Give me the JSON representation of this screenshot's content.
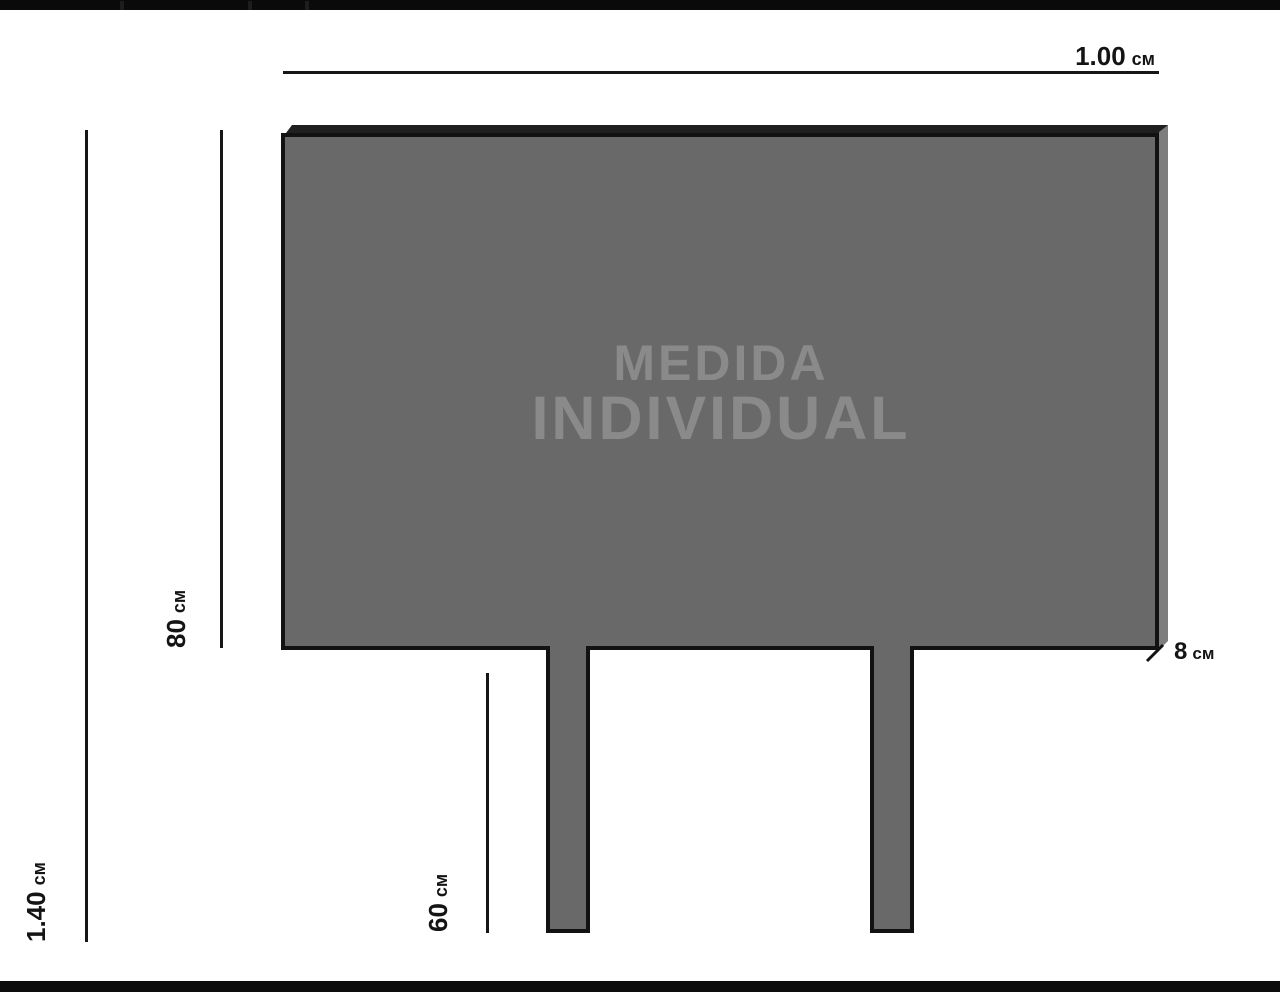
{
  "page": {
    "background_color": "#ffffff",
    "top_bar_color": "#0a0a0a",
    "bottom_bar_color": "#0d0d0d"
  },
  "watermark": {
    "line1": "MEDIDA",
    "line2": "INDIVIDUAL",
    "color": "#8a8a8a"
  },
  "panel": {
    "front_color": "#696969",
    "side_face_color": "#7d7d7d",
    "top_face_color": "#1f1f1f",
    "outline_color": "#121212"
  },
  "dimensions": {
    "total_width": {
      "value": "1.00",
      "unit": "см"
    },
    "total_height": {
      "value": "1.40",
      "unit": "см"
    },
    "panel_height": {
      "value": "80",
      "unit": "см"
    },
    "leg_height": {
      "value": "60",
      "unit": "см"
    },
    "depth": {
      "value": "8",
      "unit": "см"
    }
  }
}
